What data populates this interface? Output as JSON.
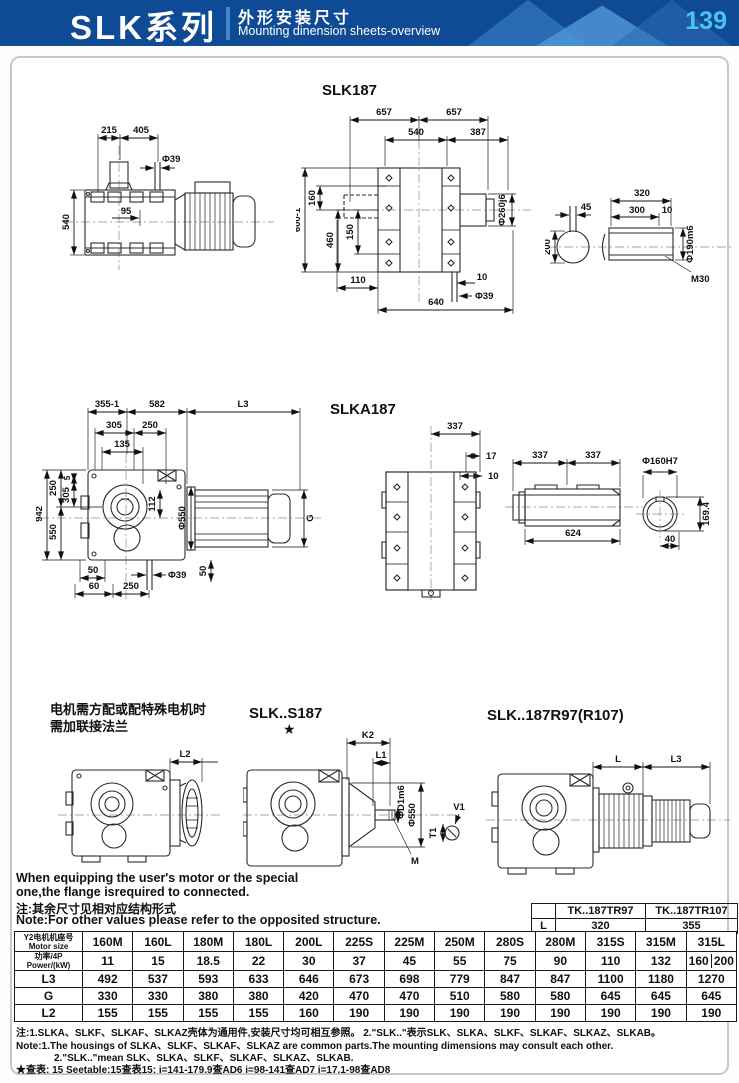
{
  "header": {
    "series": "SLK系列",
    "subtitle_cn": "外形安装尺寸",
    "subtitle_en": "Mounting dinension sheets-overview",
    "page": "139"
  },
  "colors": {
    "header_bg": "#0f4a94",
    "header_triangle_dark": "#2a6cb4",
    "header_triangle_light": "#4e95d4",
    "page_number": "#4cc2f0"
  },
  "titles": {
    "slk187": "SLK187",
    "slka187": "SLKA187",
    "s187": "SLK..S187",
    "s187_star": "★",
    "r97": "SLK..187R97(R107)"
  },
  "dims": {
    "slk187_side": [
      "215",
      "405",
      "Φ39",
      "95",
      "540"
    ],
    "slk187_front": [
      "657",
      "657",
      "540",
      "387",
      "Φ260j6",
      "160",
      "460",
      "150",
      "600-1",
      "110",
      "640",
      "10",
      "Φ39"
    ],
    "slk187_shaft": [
      "45",
      "200",
      "320",
      "300",
      "10",
      "Φ190m6",
      "M30"
    ],
    "slka187_side": [
      "355-1",
      "582",
      "L3",
      "305",
      "250",
      "135",
      "112",
      "Φ550",
      "G",
      "942",
      "250",
      "550",
      "5",
      "305",
      "Φ39",
      "50",
      "50",
      "60",
      "250"
    ],
    "slka187_front": [
      "337",
      "17",
      "10"
    ],
    "slka187_shaft": [
      "337",
      "337",
      "624"
    ],
    "slka187_bore": [
      "Φ160H7",
      "169.4",
      "40"
    ],
    "flange_version": [
      "L2"
    ],
    "s187_version": [
      "K2",
      "L1",
      "ΦD1m6",
      "Φ550",
      "M",
      "V1",
      "T1"
    ],
    "r97_version": [
      "L",
      "L3"
    ]
  },
  "flange_note": {
    "cn_line1": "电机需方配或配特殊电机时",
    "cn_line2": "需加联接法兰",
    "en_line1": "When equipping the user's motor or the special",
    "en_line2": "one,the flange isrequired to connected."
  },
  "note": {
    "cn": "注:其余尺寸见相对应结构形式",
    "en": "Note:For other values please refer to the opposited structure."
  },
  "small_table": {
    "headers": [
      "TK..187TR97",
      "TK..187TR107"
    ],
    "row_label": "L",
    "values": [
      "320",
      "355"
    ]
  },
  "main_table": {
    "size_label_cn": "Y2电机机座号",
    "size_label_en": "Motor size",
    "columns": [
      "160M",
      "160L",
      "180M",
      "180L",
      "200L",
      "225S",
      "225M",
      "250M",
      "280S",
      "280M",
      "315S",
      "315M",
      "315L"
    ],
    "rows": [
      {
        "label_cn": "功率/4P",
        "label_en": "Power/(kW)",
        "values": [
          "11",
          "15",
          "18.5",
          "22",
          "30",
          "37",
          "45",
          "55",
          "75",
          "90",
          "110",
          "132",
          [
            "160",
            "200"
          ]
        ]
      },
      {
        "label": "L3",
        "values": [
          "492",
          "537",
          "593",
          "633",
          "646",
          "673",
          "698",
          "779",
          "847",
          "847",
          "1100",
          "1180",
          "1270"
        ]
      },
      {
        "label": "G",
        "values": [
          "330",
          "330",
          "380",
          "380",
          "420",
          "470",
          "470",
          "510",
          "580",
          "580",
          "645",
          "645",
          "645"
        ]
      },
      {
        "label": "L2",
        "values": [
          "155",
          "155",
          "155",
          "155",
          "160",
          "190",
          "190",
          "190",
          "190",
          "190",
          "190",
          "190",
          "190"
        ]
      }
    ]
  },
  "footnotes": {
    "line1": "注:1.SLKA、SLKF、SLKAF、SLKAZ壳体为通用件,安装尺寸均可相互参照。  2.\"SLK..\"表示SLK、SLKA、SLKF、SLKAF、SLKAZ、SLKAB。",
    "line2": "Note:1.The housings of SLKA、SLKF、SLKAF、SLKAZ are common parts.The mounting dimensions may consult each other.",
    "line3": "2.\"SLK..\"mean SLK、SLKA、SLKF、SLKAF、SLKAZ、SLKAB.",
    "line4": "★查表: 15  Seetable:15查表15:  i=141-179.9查AD6  i=98-141查AD7  i=17.1-98查AD8"
  }
}
